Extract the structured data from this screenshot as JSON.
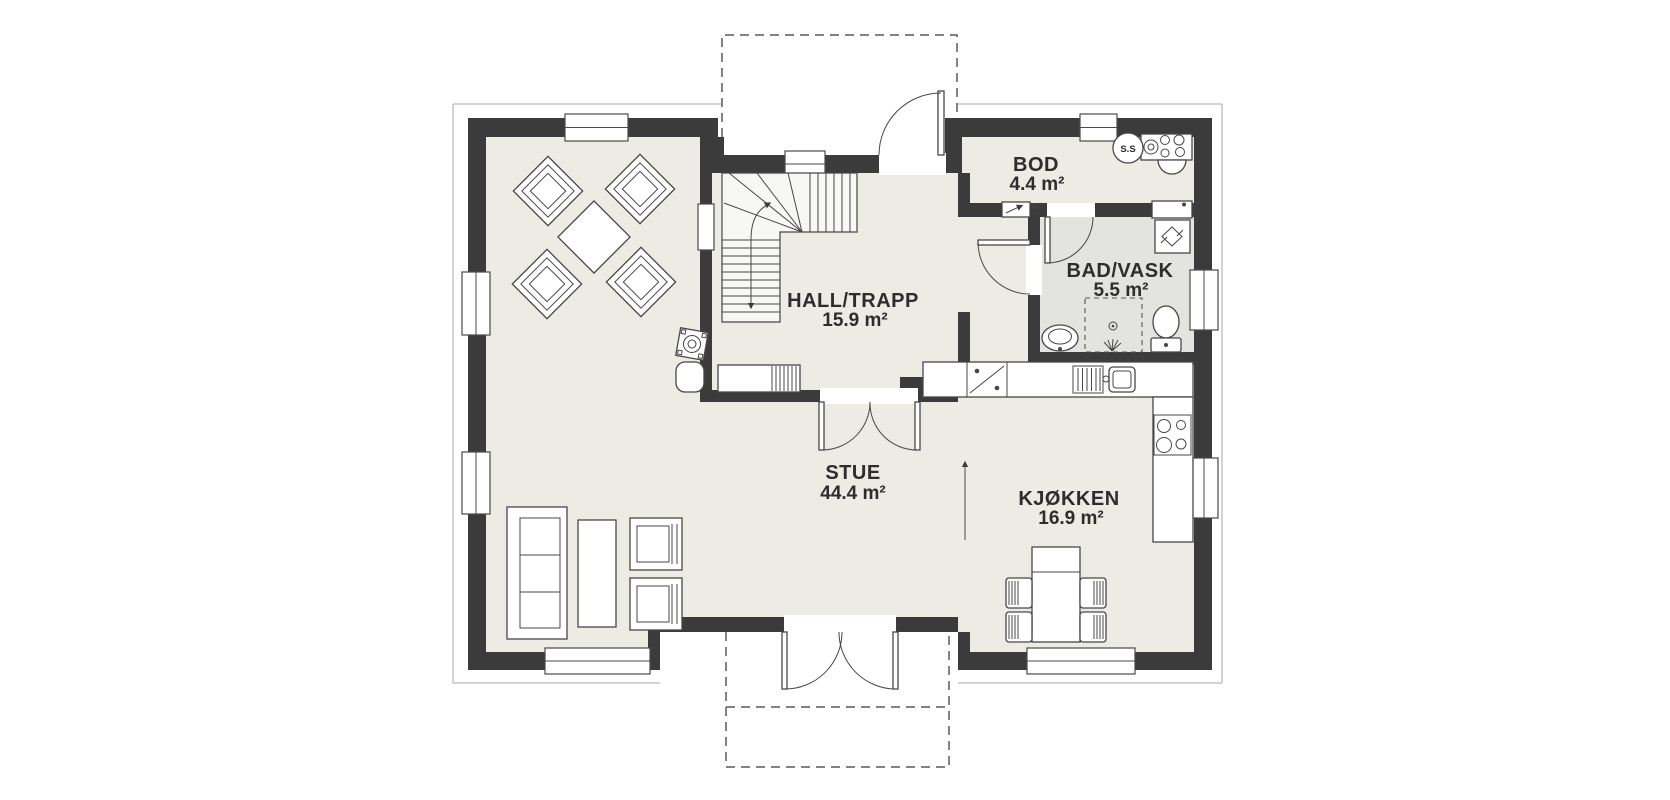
{
  "plan": {
    "rooms": [
      {
        "id": "bod",
        "name": "BOD",
        "area": "4.4 m²"
      },
      {
        "id": "bad-vask",
        "name": "BAD/VASK",
        "area": "5.5 m²"
      },
      {
        "id": "hall-trapp",
        "name": "HALL/TRAPP",
        "area": "15.9 m²"
      },
      {
        "id": "stue",
        "name": "STUE",
        "area": "44.4 m²"
      },
      {
        "id": "kjokken",
        "name": "KJØKKEN",
        "area": "16.9 m²"
      }
    ],
    "labels": {
      "washer_unit": "S.S"
    },
    "colors": {
      "wall": "#3b3b3b",
      "floor": "#ecebe4",
      "bath_floor": "#e3e3e0",
      "line": "#474747",
      "thin_outline": "#a8a8a8",
      "text": "#2d2d2d"
    }
  }
}
